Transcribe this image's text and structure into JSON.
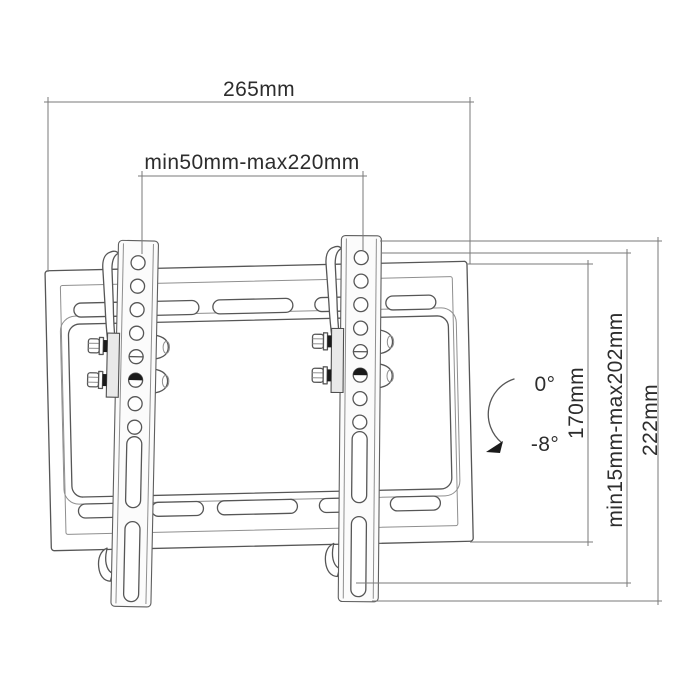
{
  "diagram": {
    "labels": {
      "overall_width": "265mm",
      "bracket_spacing_range": "min50mm-max220mm",
      "tilt_up": "0°",
      "tilt_down": "-8°",
      "plate_height": "170mm",
      "height_range": "min15mm-max202mm",
      "overall_height": "222mm"
    },
    "colors": {
      "background": "#ffffff",
      "line": "#565656",
      "thin_line": "#8f8f8f",
      "dimension_line": "#7a7a7a",
      "text": "#2d2d2d",
      "dark_accent": "#1b1b1b"
    }
  }
}
